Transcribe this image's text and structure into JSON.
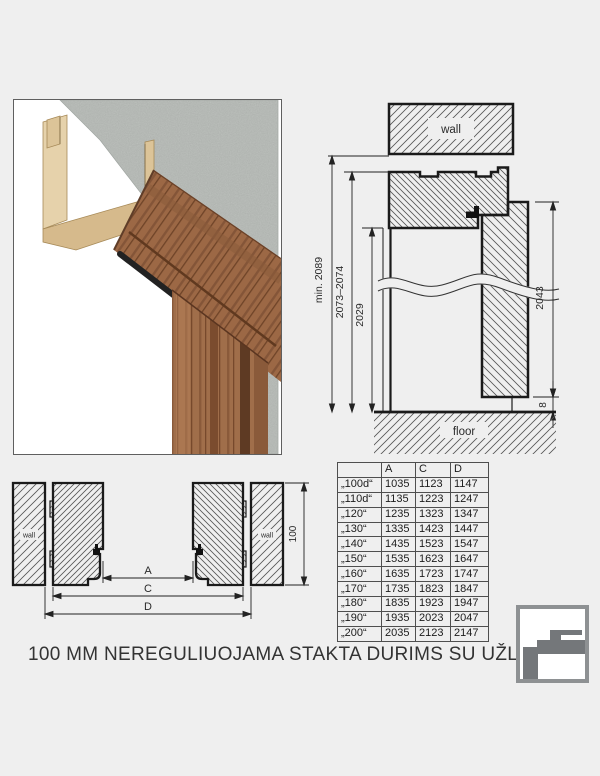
{
  "title": "100 MM NEREGULIUOJAMA STAKTA DURIMS SU UŽLAIDA",
  "vertical_section": {
    "wall_label": "wall",
    "floor_label": "floor",
    "dim_total_min": "min. 2089",
    "dim_frame_height": "2073–2074",
    "dim_opening_height": "2029",
    "dim_leaf_height": "2043",
    "dim_floor_gap": "8"
  },
  "plan_section": {
    "wall_label": "wall",
    "dim_a": "A",
    "dim_c": "C",
    "dim_d": "D",
    "dim_frame_depth": "100"
  },
  "table": {
    "headers": [
      "",
      "A",
      "C",
      "D"
    ],
    "rows": [
      {
        "label": "„100d“",
        "a": "1035",
        "c": "1123",
        "d": "1147"
      },
      {
        "label": "„110d“",
        "a": "1135",
        "c": "1223",
        "d": "1247"
      },
      {
        "label": "„120“",
        "a": "1235",
        "c": "1323",
        "d": "1347"
      },
      {
        "label": "„130“",
        "a": "1335",
        "c": "1423",
        "d": "1447"
      },
      {
        "label": "„140“",
        "a": "1435",
        "c": "1523",
        "d": "1547"
      },
      {
        "label": "„150“",
        "a": "1535",
        "c": "1623",
        "d": "1647"
      },
      {
        "label": "„160“",
        "a": "1635",
        "c": "1723",
        "d": "1747"
      },
      {
        "label": "„170“",
        "a": "1735",
        "c": "1823",
        "d": "1847"
      },
      {
        "label": "„180“",
        "a": "1835",
        "c": "1923",
        "d": "1947"
      },
      {
        "label": "„190“",
        "a": "1935",
        "c": "2023",
        "d": "2047"
      },
      {
        "label": "„200“",
        "a": "2035",
        "c": "2123",
        "d": "2147"
      }
    ]
  },
  "colors": {
    "background": "#efefef",
    "drawing_line": "#1a1a1a",
    "hatch": "#555555",
    "wood": "#9c6b49",
    "mdf": "#e0c9a0",
    "concrete": "#b9bdb9",
    "logo_gray": "#74777a"
  }
}
